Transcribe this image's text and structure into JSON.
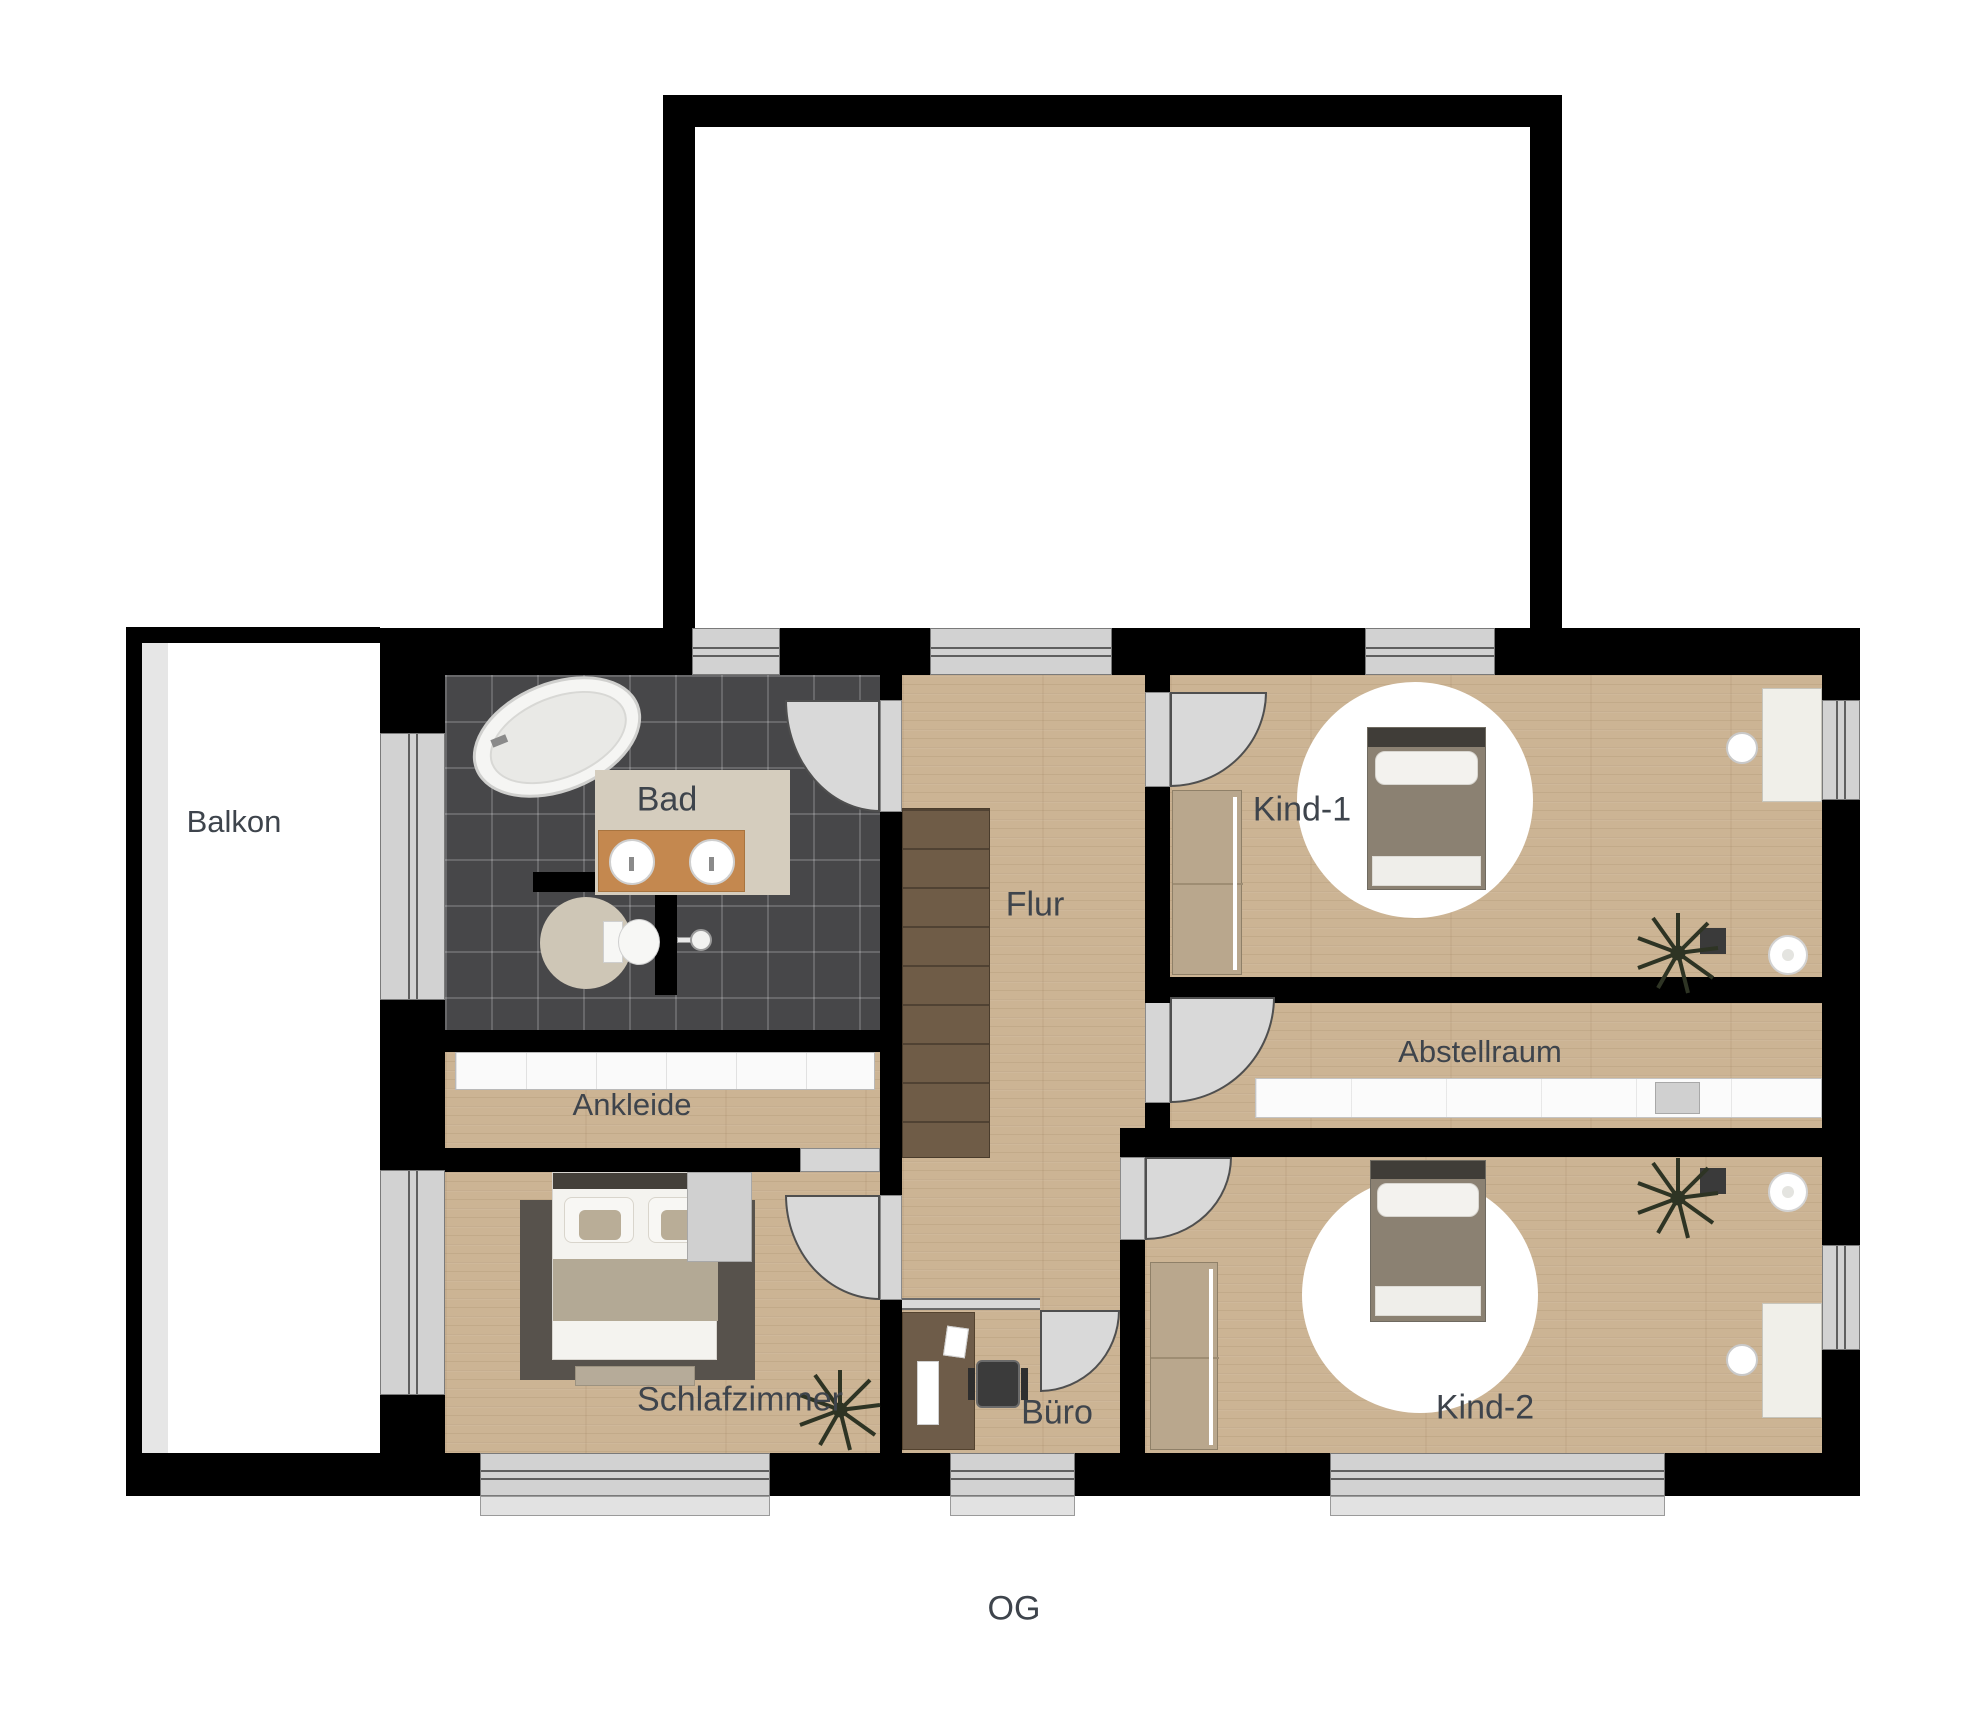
{
  "floor_title": "OG",
  "rooms": {
    "balkon": {
      "label": "Balkon"
    },
    "bad": {
      "label": "Bad"
    },
    "flur": {
      "label": "Flur"
    },
    "kind1": {
      "label": "Kind-1"
    },
    "abstellraum": {
      "label": "Abstellraum"
    },
    "kind2": {
      "label": "Kind-2"
    },
    "ankleide": {
      "label": "Ankleide"
    },
    "schlafzimmer": {
      "label": "Schlafzimmer"
    },
    "buero": {
      "label": "Büro"
    }
  },
  "objects": {
    "bathtub": "white-oval-shape",
    "vanity-double-sink": "wood-rect-two-circles",
    "toilet": "white-tank-and-bowl",
    "shower-head": "circle-with-arm",
    "stairs": "dark-wood-treads",
    "double-bed": "white-bed-two-pillows",
    "single-bed": "gray-bed-on-round-rug",
    "wardrobe": "tan-rect-sliding-door",
    "dressing-cabinets": "white-segmented-strip",
    "storage-shelf": "white-segmented-strip",
    "desk": "light-rect",
    "office-chair": "dark-square",
    "plant": "dark-starburst",
    "door": "quarter-circle-arc",
    "window": "gray-double-line-bar"
  },
  "colors": {
    "wall": "#000000",
    "wood_floor": "#ccb494",
    "bath_tiles": "#474749",
    "window_gray": "#d2d2d2",
    "door_gray": "#d9d9d9",
    "label_text": "#3e444c",
    "vanity_wood": "#c4884f",
    "stair_wood": "#6f5c47",
    "dark_rug": "#57524c",
    "mat_beige": "#d5cdbe",
    "wardrobe_tan": "#b9a78d"
  }
}
